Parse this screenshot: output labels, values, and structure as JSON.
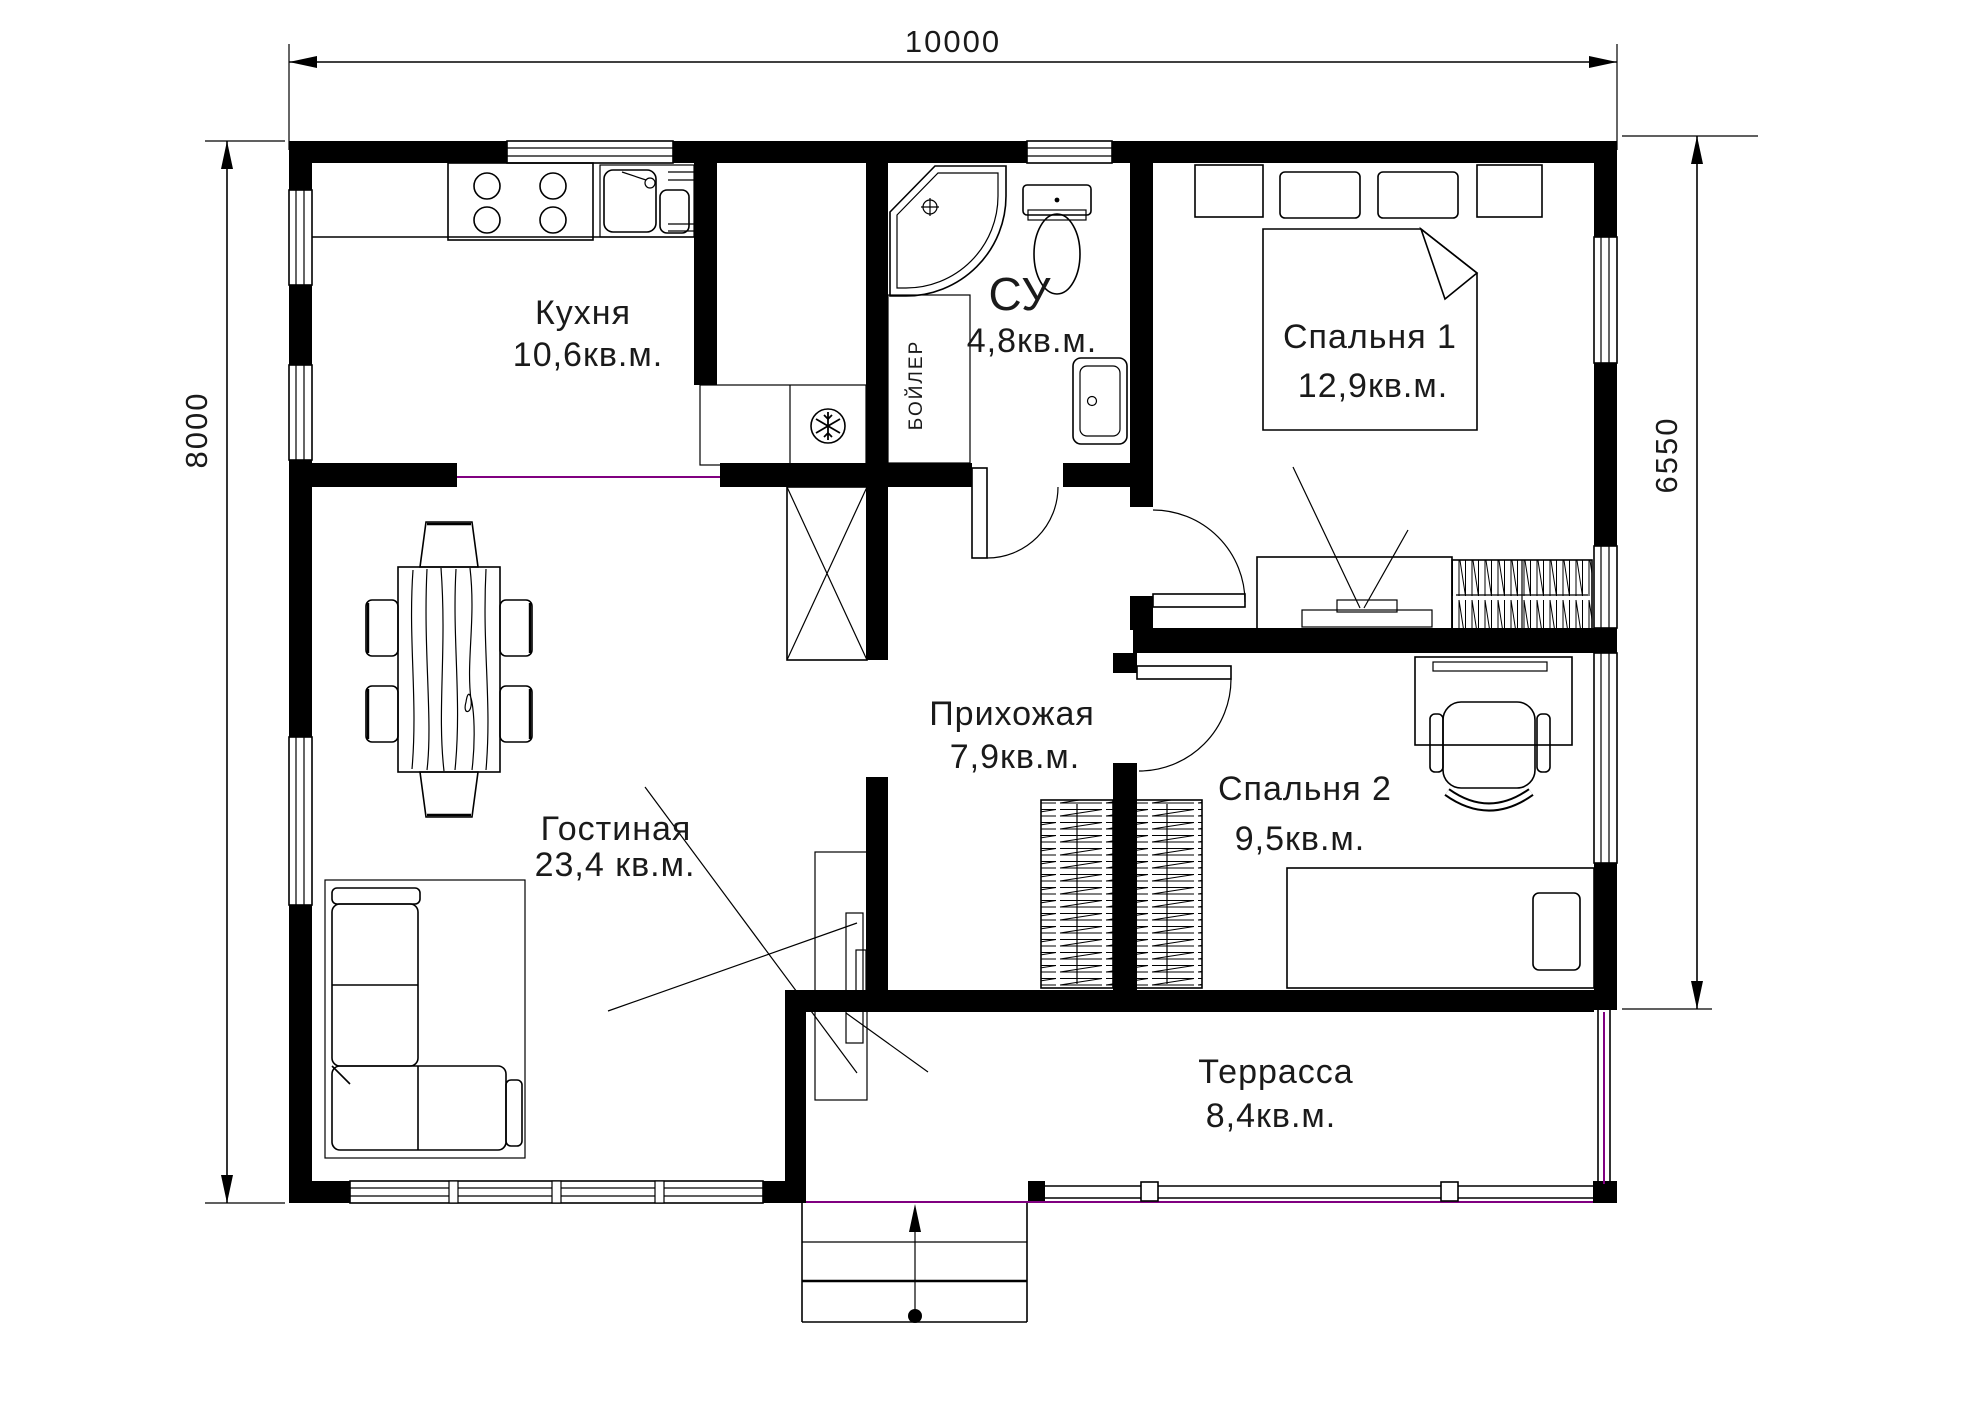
{
  "plan": {
    "dimensions": {
      "top": "10000",
      "left": "8000",
      "right": "6550"
    },
    "rooms": {
      "kitchen": {
        "name": "Кухня",
        "area": "10,6кв.м."
      },
      "bathroom": {
        "name": "СУ",
        "area": "4,8кв.м."
      },
      "bedroom1": {
        "name": "Спальня 1",
        "area": "12,9кв.м."
      },
      "hallway": {
        "name": "Прихожая",
        "area": "7,9кв.м."
      },
      "living": {
        "name": "Гостиная",
        "area": "23,4 кв.м."
      },
      "bedroom2": {
        "name": "Спальня 2",
        "area": "9,5кв.м."
      },
      "terrace": {
        "name": "Террасса",
        "area": "8,4кв.м."
      }
    },
    "labels": {
      "boiler": "БОЙЛЕР"
    },
    "colors": {
      "line": "#000000",
      "opening": "#800080"
    }
  }
}
